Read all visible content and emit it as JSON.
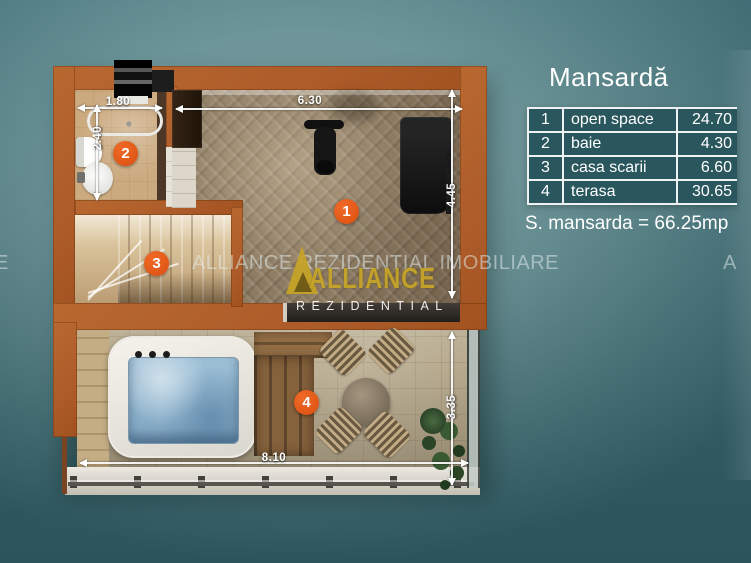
{
  "panel": {
    "title": "Mansardă",
    "table": {
      "rows": [
        {
          "num": "1",
          "name": "open space",
          "area": "24.70"
        },
        {
          "num": "2",
          "name": "baie",
          "area": "4.30"
        },
        {
          "num": "3",
          "name": "casa scarii",
          "area": "6.60"
        },
        {
          "num": "4",
          "name": "terasa",
          "area": "30.65"
        }
      ]
    },
    "summary": "S. mansarda = 66.25mp"
  },
  "plan": {
    "markers": {
      "m1": "1",
      "m2": "2",
      "m3": "3",
      "m4": "4"
    },
    "dims": {
      "bath_w": "1.80",
      "bath_h": "2.40",
      "open_w": "6.30",
      "open_h": "4.45",
      "terrace_h": "3.35",
      "terrace_w": "8.10"
    }
  },
  "watermark": {
    "banner": "ALLIANCE REZIDENTIAL IMOBILIARE",
    "edge_left": "E",
    "edge_right": "A",
    "logo_text": "ALLIANCE",
    "logo_subtext": "REZIDENTIAL"
  },
  "colors": {
    "background_teal": "#4f7d84",
    "wall_orange": "#b2612f",
    "marker_orange": "#e2571b",
    "table_cell_teal": "#2a575d",
    "logo_gold": "#c8a42c",
    "water_blue": "#9ec0d6"
  }
}
